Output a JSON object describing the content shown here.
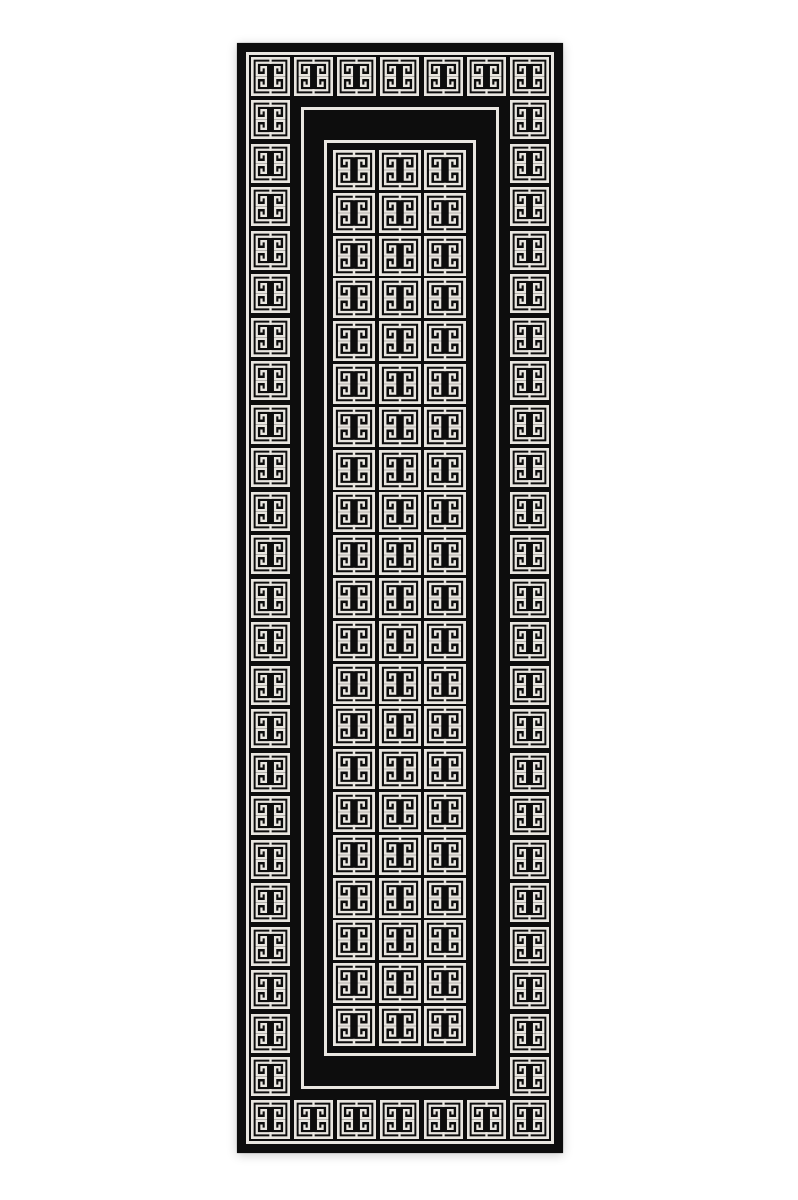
{
  "scene": {
    "type": "product-photo",
    "subject": "black and white Greek key meander runner rug",
    "background_color": "#ffffff",
    "canvas": {
      "width": 798,
      "height": 1200
    }
  },
  "rug": {
    "x": 237,
    "y": 43,
    "width": 326,
    "height": 1110,
    "black": "#0d0d0d",
    "pattern_white": "#e9e6e0",
    "outer_frame": {
      "inset": 9,
      "thickness": 3
    },
    "border_band": {
      "tile_size": 39,
      "margin": 14,
      "top_count": 7,
      "bottom_count": 7,
      "side_count": 23,
      "side_top": 57,
      "side_bottom": 57
    },
    "separator": {
      "inset": 64,
      "thickness": 3
    },
    "inner_panel": {
      "left": 87,
      "top": 97,
      "width": 152,
      "height": 916,
      "thickness": 3
    },
    "inner_grid": {
      "left": 96,
      "top": 107,
      "width": 133,
      "height": 896,
      "cols": 3,
      "rows": 21,
      "tile_w": 42,
      "tile_h": 40
    }
  }
}
